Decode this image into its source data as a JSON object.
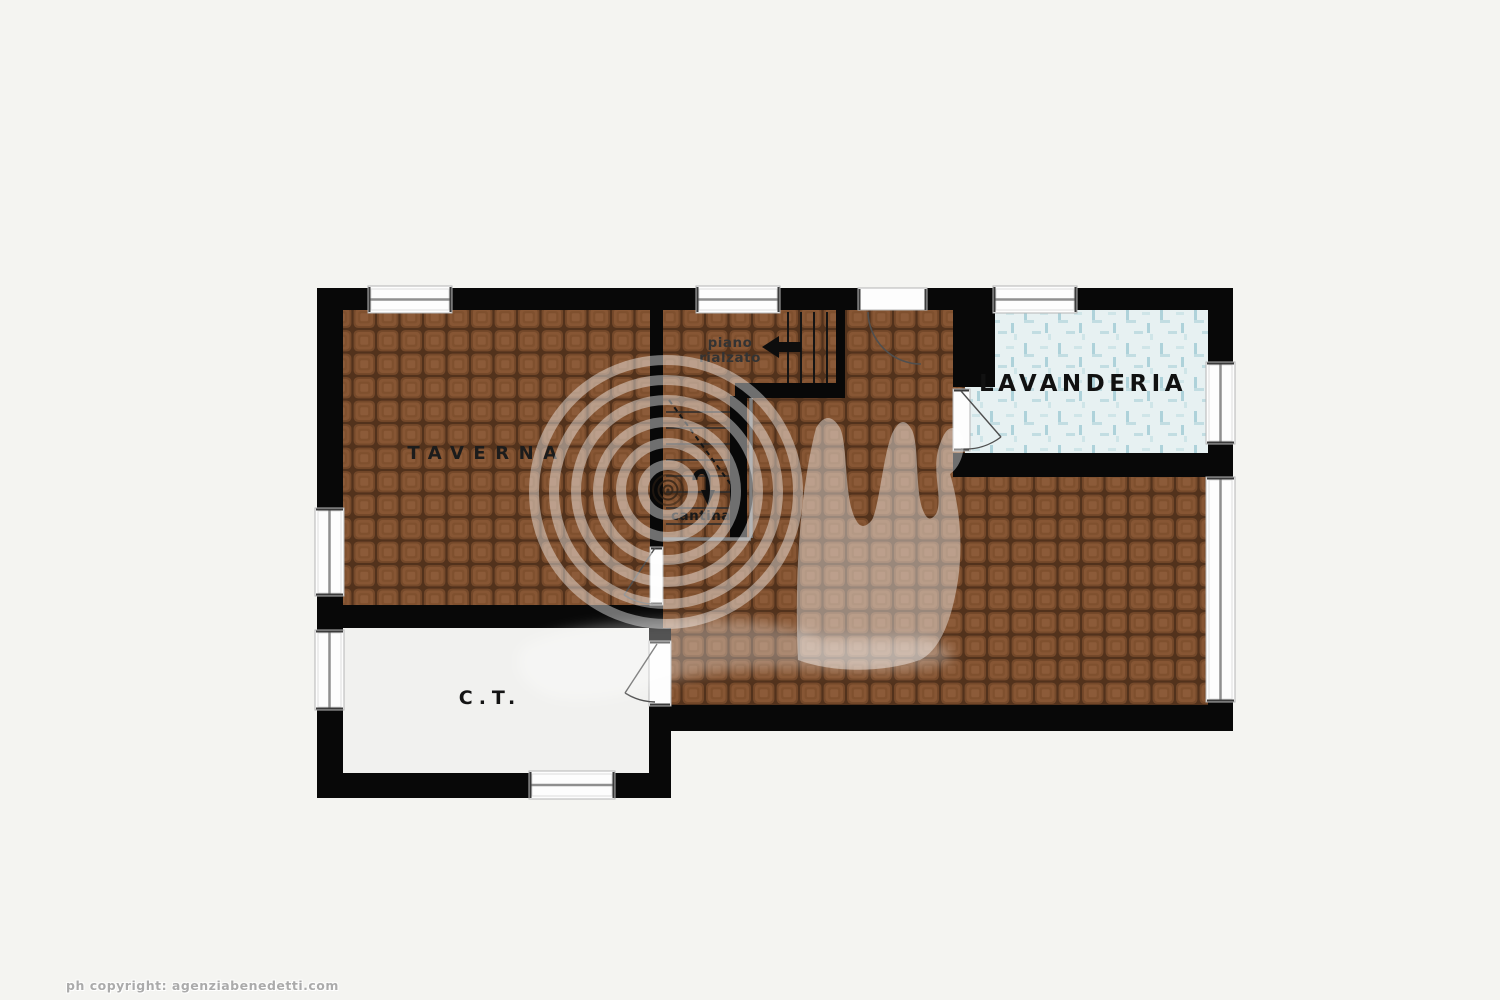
{
  "canvas": {
    "width": 1500,
    "height": 1000,
    "background": "#f4f4f1"
  },
  "rooms": [
    {
      "id": "taverna",
      "label": "TAVERNA"
    },
    {
      "id": "lavanderia",
      "label": "LAVANDERIA"
    },
    {
      "id": "ct",
      "label": "C.T."
    }
  ],
  "stairs": {
    "up_label_line1": "piano",
    "up_label_line2": "rialzato",
    "down_label": "cantina"
  },
  "icons": [
    {
      "name": "arrow-left-icon",
      "meaning": "stairs up toward piano rialzato"
    },
    {
      "name": "arrow-down-icon",
      "meaning": "stairs down toward cantina"
    },
    {
      "name": "snail-watermark-icon",
      "meaning": "agency logo watermark"
    }
  ],
  "footer": {
    "copyright_text": "ph copyright: agenziabenedetti.com"
  },
  "colors": {
    "background": "#f4f4f1",
    "wall": "#080808",
    "tile_floor": "#8d5a37",
    "tile_grout": "#54331d",
    "laundry_floor": "#e7f1f2",
    "laundry_pattern": "#aed2da",
    "ct_floor": "#f1f1ef",
    "label_text": "#1c1c1c",
    "stair_gray": "#7e7e7e",
    "watermark_white": "rgba(255,255,255,0.42)"
  }
}
